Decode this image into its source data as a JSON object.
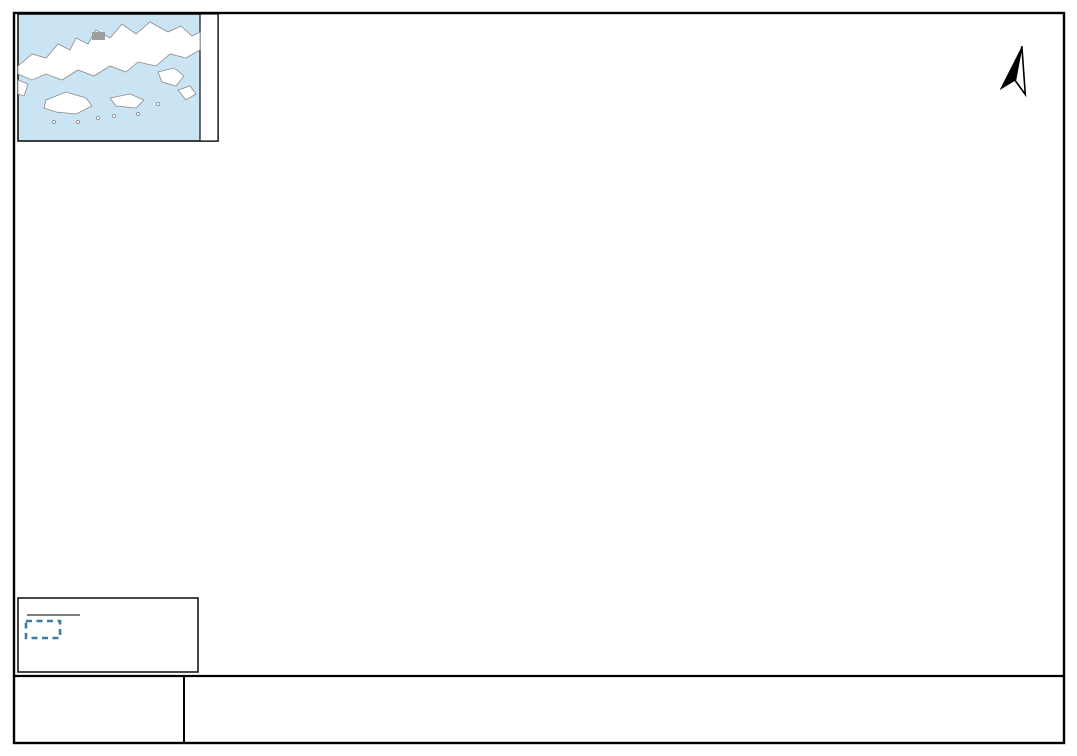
{
  "title_block": {
    "line1": "Location of Fanling Highway",
    "line2": "(Section 3  - Between Yin Kong Tsuen and Po Shek Wu Road)"
  },
  "locality_map": {
    "label": "Locality Map"
  },
  "north_arrow": {
    "label": "N"
  },
  "legend": {
    "heading": "Legend",
    "items": [
      {
        "label": "Road Section Studied"
      }
    ]
  },
  "scale_bar": {
    "tick_labels": [
      "0",
      "50",
      "100"
    ],
    "end_label": "200 Meters"
  },
  "chainage_markers": [
    "2700",
    "2800",
    "2900",
    "3000",
    "3100",
    "3200",
    "3300",
    "3400",
    "3500",
    "3600",
    "3700",
    "3800",
    "3900",
    "4000",
    "4100",
    "4200"
  ],
  "colors": {
    "boundary_blue": "#1712b2",
    "legend_sample_blue": "#3e7ca6",
    "water_blue": "#cbe4f4",
    "line_gray": "#c9c9c9",
    "label_gray": "#474747"
  },
  "map_labels": [
    {
      "t": "Wall",
      "x": 198,
      "y": 159,
      "s": 9
    },
    {
      "t": "牆",
      "x": 196,
      "y": 171,
      "s": 8.5
    },
    {
      "t": "燕崗",
      "x": 120,
      "y": 207,
      "s": 10
    },
    {
      "t": "Yin Kong",
      "x": 121,
      "y": 219,
      "s": 10.5
    },
    {
      "t": "Works in",
      "x": 513,
      "y": 197,
      "s": 8.5
    },
    {
      "t": "progress",
      "x": 513,
      "y": 207,
      "s": 8.5
    },
    {
      "t": "Tsung Pak Long",
      "x": 548,
      "y": 223,
      "s": 12
    },
    {
      "t": "嘉地",
      "x": 424,
      "y": 232,
      "s": 9
    },
    {
      "t": "10",
      "x": 406,
      "y": 198,
      "s": 8
    },
    {
      "t": "10",
      "x": 536,
      "y": 189,
      "s": 8,
      "r": 55
    },
    {
      "t": "Graves",
      "x": 418,
      "y": 278,
      "s": 9
    },
    {
      "t": "Graves",
      "x": 457,
      "y": 278,
      "s": 9
    },
    {
      "t": "P",
      "x": 546,
      "y": 283,
      "s": 9,
      "b": 1
    },
    {
      "t": "Hak Ka Wai",
      "x": 652,
      "y": 280,
      "s": 9
    },
    {
      "t": "Fence",
      "x": 131,
      "y": 268,
      "s": 8.5,
      "r": -28
    },
    {
      "t": "青山公路",
      "x": 250,
      "y": 301,
      "s": 8.5
    },
    {
      "t": "古",
      "x": 290,
      "y": 302,
      "s": 8.5
    },
    {
      "t": "粉嶺",
      "x": 313,
      "y": 333,
      "s": 10
    },
    {
      "t": "Fanling",
      "x": 317,
      "y": 345,
      "s": 10
    },
    {
      "t": "Fence",
      "x": 536,
      "y": 353,
      "s": 8.5,
      "r": -10
    },
    {
      "t": "San Tin",
      "x": 551,
      "y": 345,
      "s": 9,
      "r": -8
    },
    {
      "t": "Tai Tau Leng",
      "x": 858,
      "y": 385,
      "s": 11
    },
    {
      "t": "Fence",
      "x": 921,
      "y": 421,
      "s": 8.5
    },
    {
      "t": "Choi Po Court",
      "x": 1026,
      "y": 379,
      "s": 9
    },
    {
      "t": "Pipeline",
      "x": 1042,
      "y": 214,
      "s": 8.5,
      "r": 35
    },
    {
      "t": "FANLING",
      "x": 1036,
      "y": 511,
      "s": 12.5,
      "r": 22,
      "ls": 2
    },
    {
      "t": "Open Storage",
      "x": 888,
      "y": 528,
      "s": 9,
      "r": 22
    },
    {
      "t": "Fanling Lodge",
      "x": 510,
      "y": 623,
      "s": 9
    },
    {
      "t": "Fence",
      "x": 697,
      "y": 553,
      "s": 8.5,
      "r": 22
    },
    {
      "t": "Fence",
      "x": 504,
      "y": 641,
      "s": 8.5,
      "r": 28
    },
    {
      "t": "Fence",
      "x": 884,
      "y": 583,
      "s": 8.5,
      "r": -70
    },
    {
      "t": "Pipeline",
      "x": 888,
      "y": 637,
      "s": 8.5,
      "r": -62
    },
    {
      "t": "10",
      "x": 588,
      "y": 622,
      "s": 8,
      "r": 40
    },
    {
      "t": "10",
      "x": 714,
      "y": 588,
      "s": 8,
      "r": 75
    },
    {
      "t": "20",
      "x": 35,
      "y": 570,
      "s": 8,
      "r": 10
    },
    {
      "t": "20",
      "x": 956,
      "y": 641,
      "s": 8,
      "r": 45
    },
    {
      "t": "金錢",
      "x": 88,
      "y": 491,
      "s": 10
    },
    {
      "t": "Kam Tsin",
      "x": 86,
      "y": 503,
      "s": 10.5
    },
    {
      "t": "P",
      "x": 220,
      "y": 438,
      "s": 9,
      "b": 1
    },
    {
      "t": "金錢路",
      "x": 25,
      "y": 483,
      "s": 8,
      "r": 55
    },
    {
      "t": "金錢輋路",
      "x": 90,
      "y": 525,
      "s": 8,
      "r": 38
    },
    {
      "t": "Wall",
      "x": 109,
      "y": 567,
      "s": 8.5,
      "r": -50
    },
    {
      "t": "牆",
      "x": 92,
      "y": 578,
      "s": 8,
      "r": -50
    },
    {
      "t": "Wall",
      "x": 268,
      "y": 553,
      "s": 8.5,
      "r": -75
    },
    {
      "t": "P",
      "x": 272,
      "y": 42,
      "s": 9,
      "b": 1
    },
    {
      "t": "P",
      "x": 430,
      "y": 25,
      "s": 9,
      "b": 1
    },
    {
      "t": "P",
      "x": 393,
      "y": 118,
      "s": 9,
      "b": 1
    },
    {
      "t": "P",
      "x": 455,
      "y": 145,
      "s": 9,
      "b": 1
    },
    {
      "t": "SAN WAN ROAD",
      "x": 884,
      "y": 38,
      "s": 8.5,
      "r": 44,
      "st": 1
    },
    {
      "t": "CHOI FAT STREET",
      "x": 813,
      "y": 112,
      "s": 8.5,
      "r": -44,
      "st": 1
    },
    {
      "t": "CHOI FAI STREET",
      "x": 853,
      "y": 146,
      "s": 8.5,
      "r": 42,
      "st": 1
    },
    {
      "t": "CHOI YUEN ROAD",
      "x": 818,
      "y": 187,
      "s": 8.5,
      "r": 35,
      "st": 1
    },
    {
      "t": "PO SHEK WU ROAD",
      "x": 1036,
      "y": 112,
      "s": 8.5,
      "r": -52,
      "st": 1
    },
    {
      "t": "CASTLE PEAK ROAD-KWU TUNG",
      "x": 594,
      "y": 446,
      "s": 8.5,
      "r": 33,
      "st": 1
    },
    {
      "t": "Fence",
      "x": 1007,
      "y": 148,
      "s": 8.5,
      "r": -60
    },
    {
      "t": "Fence",
      "x": 893,
      "y": 193,
      "s": 8.5,
      "r": -68
    },
    {
      "t": "Fence",
      "x": 665,
      "y": 178,
      "s": 8.5,
      "r": 30
    },
    {
      "t": "榕",
      "x": 86,
      "y": 244,
      "s": 8
    },
    {
      "t": "稻",
      "x": 63,
      "y": 423,
      "s": 8
    },
    {
      "t": "圃",
      "x": 300,
      "y": 443,
      "s": 8
    },
    {
      "t": "樹",
      "x": 347,
      "y": 530,
      "s": 8
    },
    {
      "t": "桐",
      "x": 346,
      "y": 397,
      "s": 8
    },
    {
      "t": "9",
      "x": 760,
      "y": 115,
      "s": 7.5,
      "r": -75
    },
    {
      "t": "6",
      "x": 862,
      "y": 138,
      "s": 7.5,
      "r": -45
    }
  ]
}
